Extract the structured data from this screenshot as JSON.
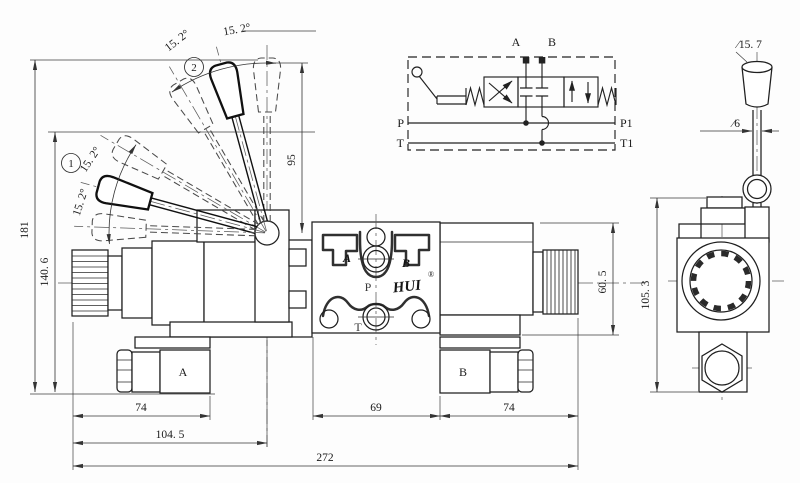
{
  "front": {
    "dim_overall_height": "181",
    "dim_lever_low_height": "140. 6",
    "dim_pivot_height": "95",
    "angle_labels": [
      "15. 2°",
      "15. 2°",
      "15. 2°",
      "15. 2°"
    ],
    "position_1": "1",
    "position_2": "2",
    "connector_a": "A",
    "connector_b": "B",
    "dim_left_74": "74",
    "dim_104_5": "104. 5",
    "dim_69": "69",
    "dim_right_74": "74",
    "dim_272": "272",
    "dim_60_5": "60. 5"
  },
  "plate": {
    "port_a": "A",
    "port_b": "B",
    "port_p": "P",
    "port_t": "T",
    "logo": "HUI",
    "registered": "®"
  },
  "schematic": {
    "port_a": "A",
    "port_b": "B",
    "port_p": "P",
    "port_t": "T",
    "port_p1": "P1",
    "port_t1": "T1"
  },
  "side": {
    "dim_knob_dia": "∕15. 7",
    "dim_rod_dia": "∕6",
    "dim_height": "105. 3"
  }
}
